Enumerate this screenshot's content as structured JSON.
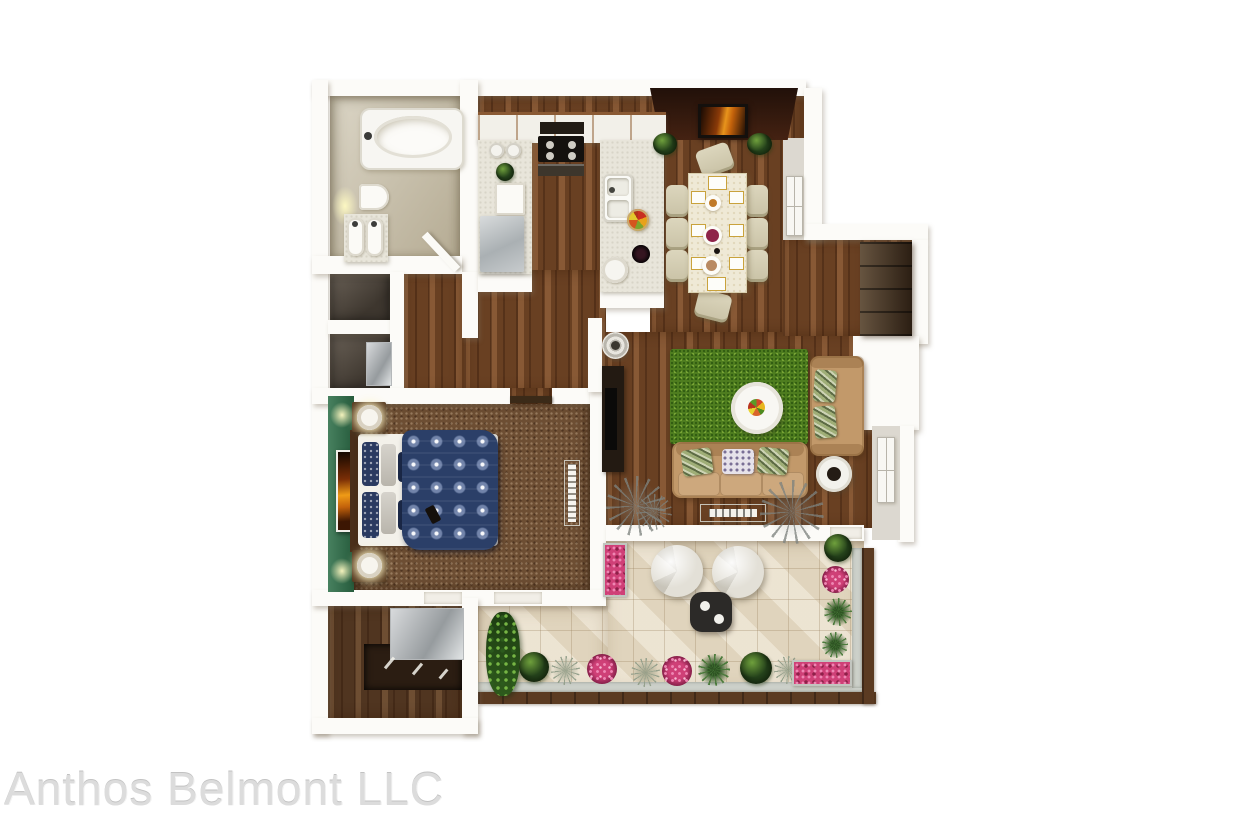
{
  "watermark": {
    "text": "Anthos Belmont LLC",
    "color": "#dcdcdc"
  },
  "palette": {
    "background": "#ffffff",
    "wall": "#fcfbf8",
    "wood_floor": "#7a4a28",
    "closet_wood": "#5d3e25",
    "cabinet_dark_wood": "#3c2a1a",
    "bedroom_carpet": "#6d4e33",
    "bathroom_tile": "#ccc4ae",
    "patio_tile": "#e9dfca",
    "rug_green": "#4e7d1f",
    "sofa_tan": "#c2996a",
    "dining_accent_wall": "#33190e",
    "bedroom_accent_wall": "#2e6f49",
    "bedding_navy": "#2b3f68",
    "flower_pink": "#cf4077",
    "plant_green": "#2c4a1c",
    "patio_rail_brown": "#5b3b22",
    "closet_silver": "#b9bec1"
  },
  "rooms": [
    {
      "name": "bathroom",
      "items": [
        "bathtub",
        "toilet",
        "double-sink-vanity"
      ]
    },
    {
      "name": "hallway",
      "items": [
        "linen-closet",
        "laundry-closet",
        "washer",
        "open-door"
      ]
    },
    {
      "name": "kitchen",
      "items": [
        "upper-cabinets",
        "range-hood",
        "cooktop",
        "oven",
        "refrigerator",
        "double-sink",
        "fruit-bowl",
        "canisters",
        "plant"
      ]
    },
    {
      "name": "dining-area",
      "items": [
        "dining-table",
        "eight-chairs",
        "place-settings",
        "wall-art",
        "corner-plants"
      ]
    },
    {
      "name": "entry",
      "items": [
        "closet-cabinet",
        "window",
        "storage-block"
      ]
    },
    {
      "name": "living-room",
      "items": [
        "sofa",
        "loveseat",
        "green-area-rug",
        "round-coffee-table",
        "tv-console",
        "round-side-table",
        "baseboard-heater",
        "window",
        "decor-plants"
      ]
    },
    {
      "name": "bedroom",
      "items": [
        "bed",
        "patterned-duvet",
        "nightstands",
        "lamps",
        "wall-art",
        "air-vent"
      ]
    },
    {
      "name": "walk-in-closet",
      "items": [
        "shelving",
        "mirror-panel",
        "hangers"
      ]
    },
    {
      "name": "patio",
      "items": [
        "lounge-poufs",
        "black-side-table",
        "flower-planters",
        "shrubs",
        "grasses",
        "railing"
      ]
    }
  ]
}
